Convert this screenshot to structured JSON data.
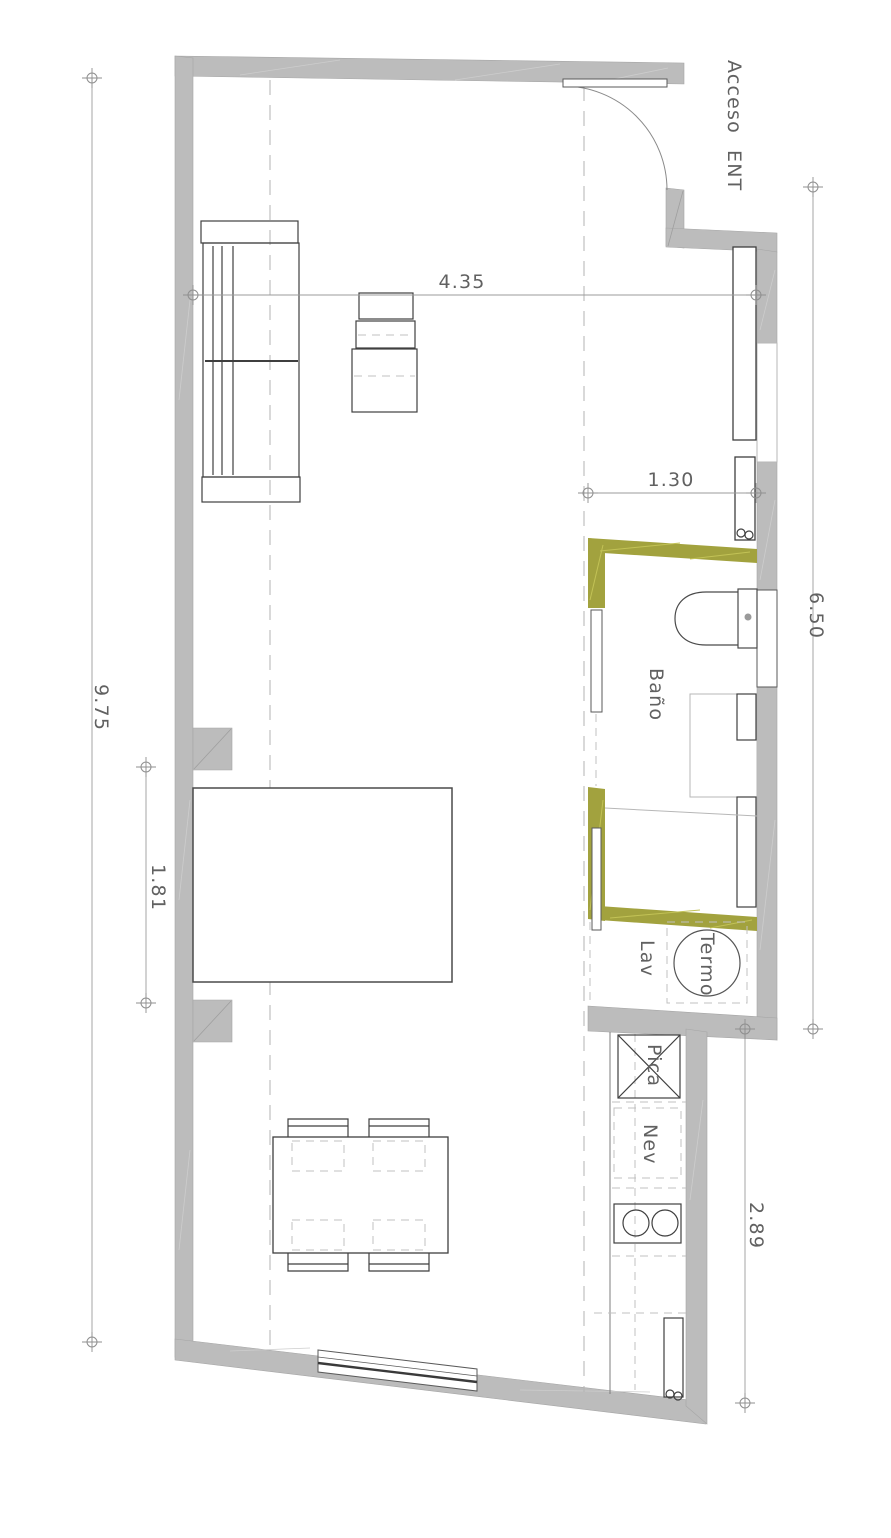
{
  "labels": {
    "entrance_line1": "Acceso",
    "entrance_line2": "ENT",
    "bathroom": "Baño",
    "laundry": "Lav",
    "water_heater": "Termo",
    "sink": "Pica",
    "fridge": "Nev"
  },
  "dimensions": {
    "left_total_height": "9.75",
    "living_width": "4.35",
    "bath_passage_width": "1.30",
    "right_upper_height": "6.50",
    "bed_zone_height": "1.81",
    "kitchen_zone_height": "2.89"
  },
  "colors": {
    "wall": "#bcbcbc",
    "partition": "#a2a23e",
    "text": "#616161"
  }
}
